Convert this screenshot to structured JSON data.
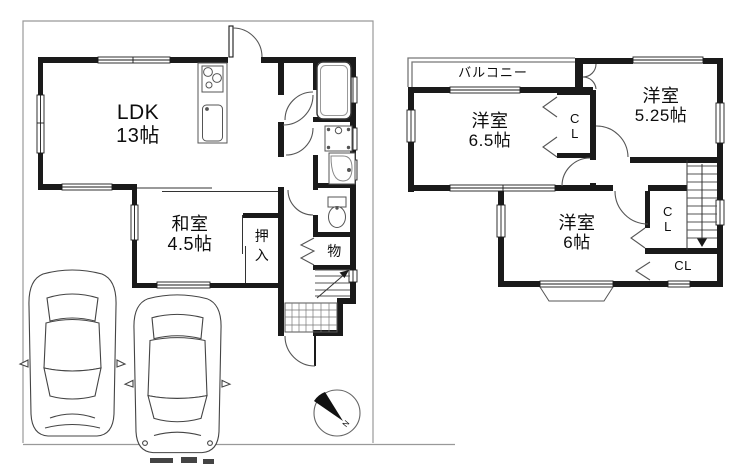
{
  "floor1": {
    "ldk": {
      "label": "LDK",
      "size": "13帖"
    },
    "washitsu": {
      "label": "和室",
      "size": "4.5帖"
    },
    "oshiire": {
      "line1": "押",
      "line2": "入"
    },
    "storage": {
      "label": "物"
    }
  },
  "floor2": {
    "balcony": {
      "label": "バルコニー"
    },
    "room_65": {
      "label": "洋室",
      "size": "6.5帖"
    },
    "room_525": {
      "label": "洋室",
      "size": "5.25帖"
    },
    "room_6": {
      "label": "洋室",
      "size": "6帖"
    },
    "closet_mid": {
      "line1": "C",
      "line2": "L"
    },
    "closet_right": {
      "line1": "C",
      "line2": "L"
    },
    "closet_bottom": {
      "label": "CL"
    }
  },
  "compass": {
    "north_label": "N"
  },
  "colors": {
    "wall": "#1a1a1a",
    "line": "#555555",
    "boundary": "#999999",
    "background": "#ffffff"
  }
}
